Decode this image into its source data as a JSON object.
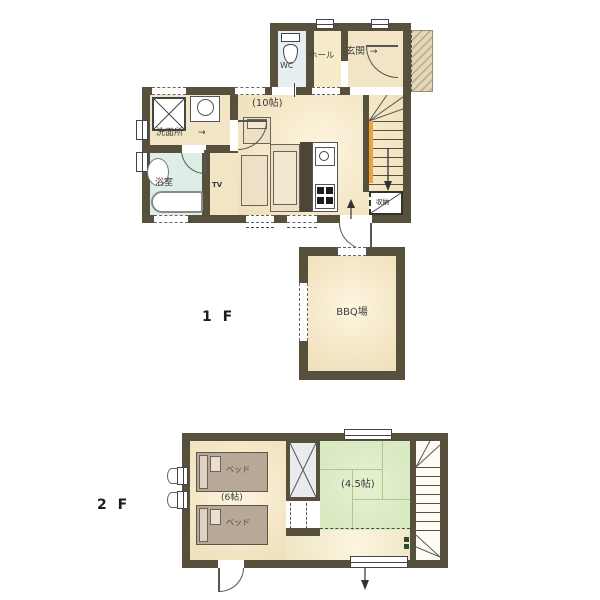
{
  "floor1": {
    "label": "1 F",
    "wc": "WC",
    "hall": "ホール",
    "entrance": "玄関",
    "entrance_arrow": "→",
    "living_size": "(10帖)",
    "washroom": "洗面所",
    "washroom_arrow": "→",
    "bath": "浴室",
    "tv": "TV",
    "storage": "収納",
    "bbq": "BBQ場"
  },
  "floor2": {
    "label": "2 F",
    "bed": "ベッド",
    "bedroom_size": "(6帖)",
    "tatami_size": "(4.5帖)"
  },
  "colors": {
    "wall": "#57503c",
    "floor_cream": "#f4e6c5",
    "floor_highlight": "#fdf5e0",
    "bath_green": "#ddeee6",
    "wc_blue": "#e7eef1",
    "hall_yellow": "#f6ecca",
    "tatami_green": "#dcebc6",
    "hall2f_cream": "#f7f0d6",
    "bed_tan": "#b7a898",
    "handrail_orange": "#f0a33c",
    "kitchen_counter_brown": "#4e4537",
    "porch_beige": "#e3d7b8",
    "closet_gray": "#e9ebec",
    "stair_marker_green": "#2c4a36"
  }
}
